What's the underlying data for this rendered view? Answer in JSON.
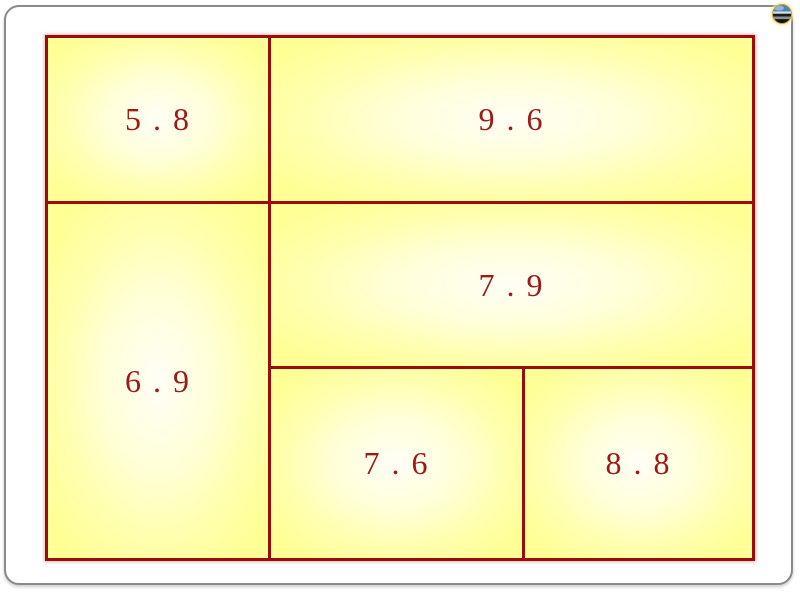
{
  "app": {
    "type": "presentation-slide"
  },
  "slide": {
    "colors": {
      "frame_border": "#8a8a8a",
      "slide_background": "#ffffff",
      "grid_border": "#9b0c0c",
      "cell_edge_yellow": "#ffff96",
      "cell_center": "#fffef6",
      "number_text": "#9c1a1a",
      "sphere_glow": "#efe170",
      "sphere_blue": "#4f81bd"
    },
    "nav_button": {
      "icon": "striped-sphere-icon"
    },
    "grid": {
      "cells": [
        {
          "position": "top-left",
          "value": "5 . 8"
        },
        {
          "position": "top-right",
          "value": "9 . 6"
        },
        {
          "position": "middle-left",
          "value": "6 . 9"
        },
        {
          "position": "middle-right",
          "value": "7 . 9"
        },
        {
          "position": "bottom-center",
          "value": "7 . 6"
        },
        {
          "position": "bottom-right",
          "value": "8 . 8"
        }
      ]
    }
  }
}
